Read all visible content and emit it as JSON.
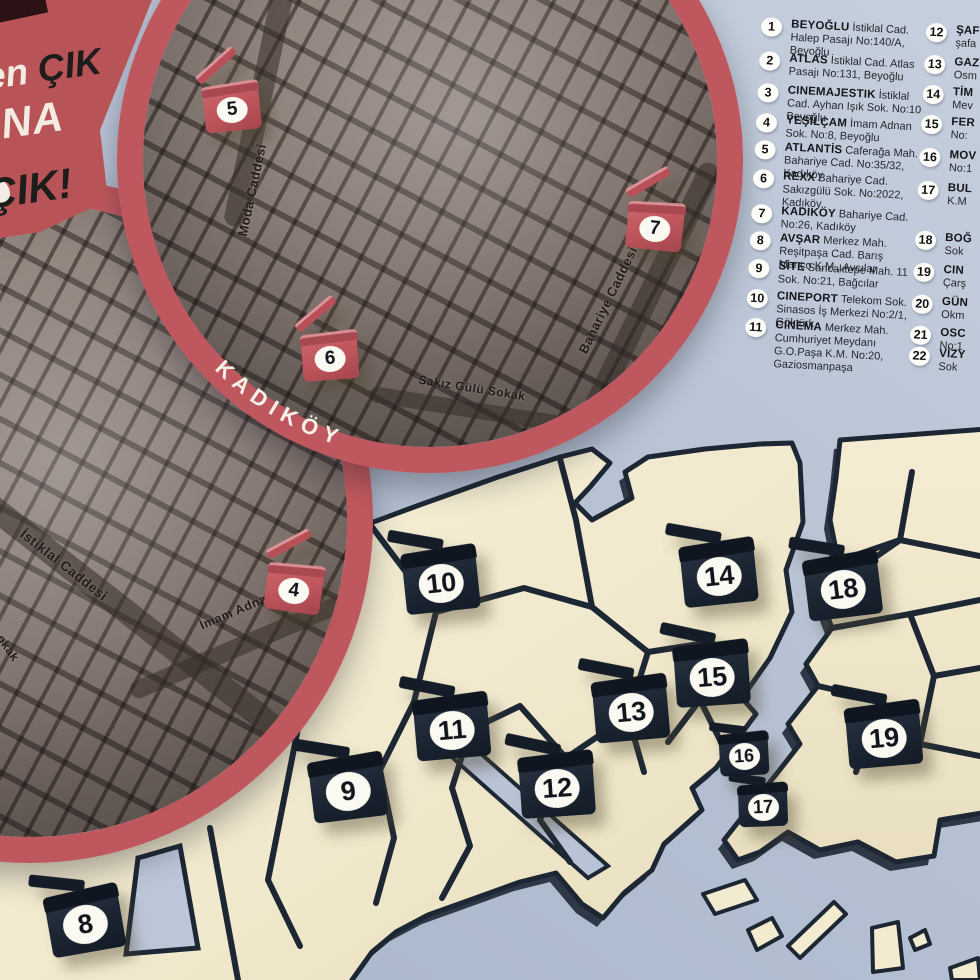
{
  "poster": {
    "slogan": {
      "line1_white": "den",
      "line1_black": " ÇIK",
      "line2_white": "MANA",
      "line3_black": "ÇIK!"
    },
    "colors": {
      "accent_red": "#bd545b",
      "navy": "#1d2734",
      "land_cream": "#f1e9cd",
      "water_blue": "#b7c2d4",
      "city_taupe": "#887b75",
      "badge_white": "#fdfdf9"
    }
  },
  "kadikoy_circle": {
    "ring_label": "KADIKÖY",
    "street_moda": "Moda Caddesi",
    "street_sakiz": "Sakız Gülü Sokak",
    "street_bahariye": "Bahariye Caddesi"
  },
  "beyoglu_circle": {
    "street_istiklal": "İstiklal Caddesi",
    "street_imam": "İmam Adnan S",
    "street_fragment": "okak"
  },
  "markers": {
    "m4": "4",
    "m5": "5",
    "m6": "6",
    "m7": "7",
    "m8": "8",
    "m9": "9",
    "m10": "10",
    "m11": "11",
    "m12": "12",
    "m13": "13",
    "m14": "14",
    "m15": "15",
    "m16": "16",
    "m17": "17",
    "m18": "18",
    "m19": "19"
  },
  "legend": {
    "items": [
      {
        "num": "1",
        "name": "BEYOĞLU",
        "address": "İstiklal Cad. Halep Pasajı No:140/A, Beyoğlu"
      },
      {
        "num": "2",
        "name": "ATLAS",
        "address": "İstiklal Cad. Atlas Pasajı No:131, Beyoğlu"
      },
      {
        "num": "3",
        "name": "CINEMAJESTIK",
        "address": "İstiklal Cad. Ayhan Işık Sok. No:10 Beyoğlu"
      },
      {
        "num": "4",
        "name": "YEŞİLÇAM",
        "address": "İmam Adnan Sok. No:8, Beyoğlu"
      },
      {
        "num": "5",
        "name": "ATLANTİS",
        "address": "Caferağa Mah. Bahariye Cad. No:35/32, Kadıköy"
      },
      {
        "num": "6",
        "name": "REXX",
        "address": "Bahariye Cad. Sakızgülü Sok. No:2022, Kadıköy"
      },
      {
        "num": "7",
        "name": "KADIKÖY",
        "address": "Bahariye Cad. No:26, Kadıköy"
      },
      {
        "num": "8",
        "name": "AVŞAR",
        "address": "Merkez Mah. Reşitpaşa Cad. Barış Manço K.M., Avcılar"
      },
      {
        "num": "9",
        "name": "SİTE",
        "address": "Sancaktepe Mah. 11 Sok. No:21, Bağcılar"
      },
      {
        "num": "10",
        "name": "CINEPORT",
        "address": "Telekom Sok. Sinasos İş Merkezi No:2/1, Göktürk"
      },
      {
        "num": "11",
        "name": "CINEMA",
        "address": "Merkez Mah. Cumhuriyet Meydanı G.O.Paşa K.M. No:20, Gaziosmanpaşa"
      },
      {
        "num": "12",
        "name": "ŞAF",
        "address": "şafa"
      },
      {
        "num": "13",
        "name": "GAZ",
        "address": "Osm"
      },
      {
        "num": "14",
        "name": "TİM",
        "address": "Mev"
      },
      {
        "num": "15",
        "name": "FER",
        "address": "No:"
      },
      {
        "num": "16",
        "name": "MOV",
        "address": "No:1"
      },
      {
        "num": "17",
        "name": "BUL",
        "address": "K.M"
      },
      {
        "num": "18",
        "name": "BOĞ",
        "address": "Sok"
      },
      {
        "num": "19",
        "name": "CIN",
        "address": "Çarş"
      },
      {
        "num": "20",
        "name": "GÜN",
        "address": "Okm"
      },
      {
        "num": "21",
        "name": "OSC",
        "address": "No:1"
      },
      {
        "num": "22",
        "name": "VİZY",
        "address": "Sok"
      }
    ]
  }
}
